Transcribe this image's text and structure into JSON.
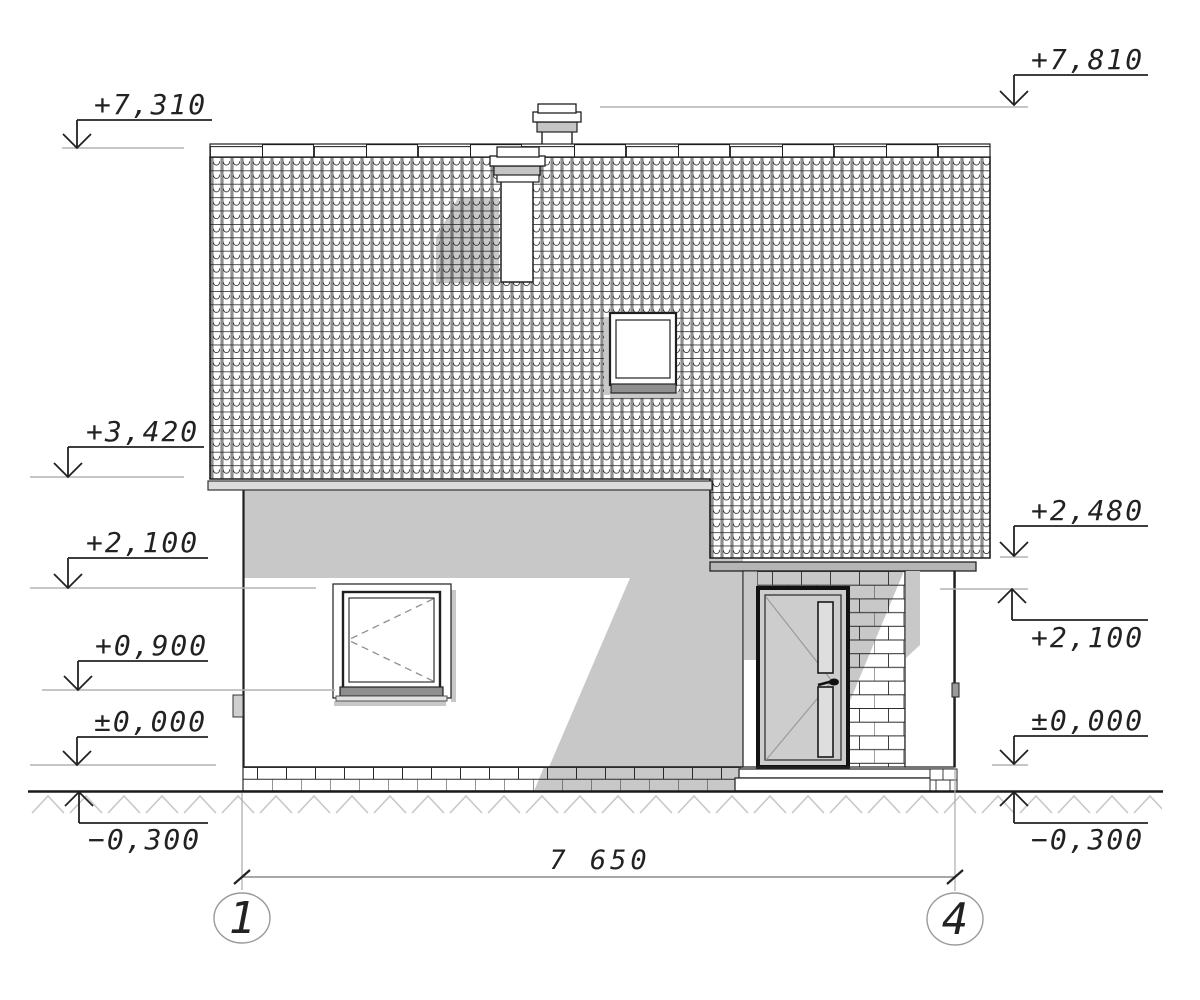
{
  "drawing": {
    "type": "architectural elevation (side facade, axes 1-4)",
    "dimension_label": "7 650",
    "axis_left": "1",
    "axis_right": "4",
    "levels_left": {
      "ridge": "+7,310",
      "eaves": "+3,420",
      "lintel": "+2,100",
      "sill": "+0,900",
      "floor": "±0,000",
      "grade": "−0,300"
    },
    "levels_right": {
      "chimney_top": "+7,810",
      "porch_eaves": "+2,480",
      "lintel": "+2,100",
      "floor": "±0,000",
      "grade": "−0,300"
    },
    "colors": {
      "line": "#1f1f1f",
      "shadow": "#c8c8c8",
      "roof_shadow": "#bdbdbd",
      "level_line": "#b4b4b4",
      "fascia_light": "#dcdcdc",
      "fascia_dark": "#b5b5b5",
      "door_leaf": "#cdcdcd",
      "door_glass": "#dedede",
      "window_sill": "#8f8f8f",
      "chimney_band": "#c4c4c4",
      "ground_hatch": "#c7c7c7",
      "dimension_line": "#8a8a8a",
      "axis_circle": "#9a9a9a"
    }
  }
}
